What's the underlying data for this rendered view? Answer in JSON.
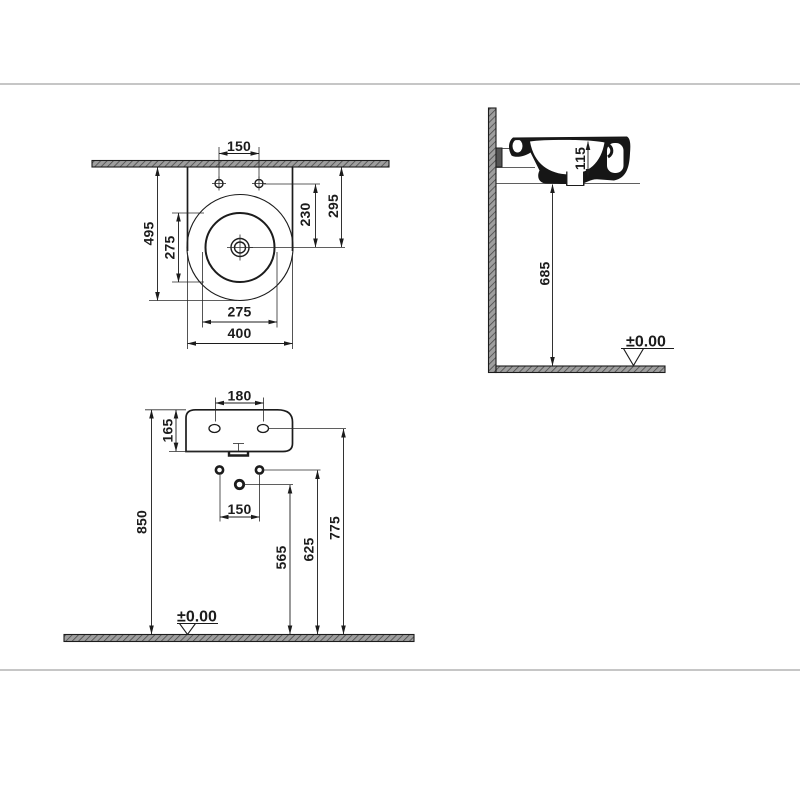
{
  "plan": {
    "tap_hole_spacing": "150",
    "total_depth": "495",
    "bowl_diameter_vertical": "275",
    "tap_to_drain": "230",
    "wall_to_drain": "295",
    "bowl_diameter_horizontal": "275",
    "total_width": "400"
  },
  "side": {
    "bowl_depth": "115",
    "floor_to_underside": "685",
    "floor_datum": "±0.00"
  },
  "front": {
    "tap_hole_spacing": "180",
    "rim_height": "165",
    "floor_to_rim": "850",
    "fixing_hole_spacing": "150",
    "floor_to_waste": "565",
    "floor_to_fixing": "625",
    "floor_to_taps": "775",
    "floor_datum": "±0.00"
  },
  "colors": {
    "line": "#1c1c1c",
    "hatch_fill": "#9e9e9e",
    "hatch_line": "#454545",
    "page_border": "#c6c6c6",
    "background": "#ffffff"
  }
}
